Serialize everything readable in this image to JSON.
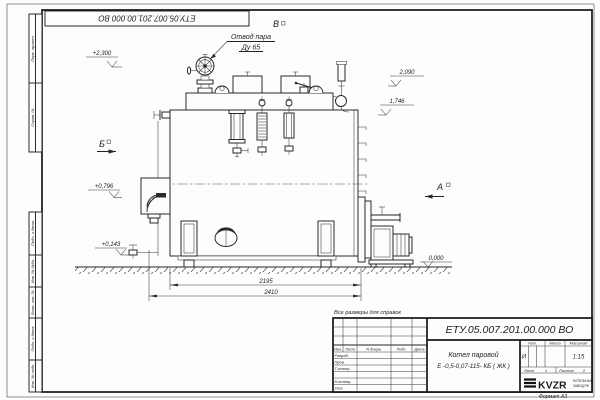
{
  "stamp": {
    "doc_number_rotated": "ЕТУ.05.007.201.00.000  ВО"
  },
  "margin_columns": {
    "top": [
      "Перв. примен.",
      "Справ. №"
    ],
    "bottom": [
      "Подп. и дата",
      "Инв. № дубл.",
      "Взам. инв. №",
      "Подп. и дата",
      "Инв. № подл."
    ]
  },
  "drawing": {
    "callout_steam_outlet": {
      "line1": "Отвод пара",
      "line2": "Ду 65"
    },
    "view_markers": {
      "b": "Б",
      "a": "А",
      "v": "В"
    },
    "elevation_marks": {
      "m2300": "+2,300",
      "m2090": "2,090",
      "m1746": "1,746",
      "m0796": "+0,796",
      "m0143": "+0,143",
      "m0000": "0,000"
    },
    "dimensions": {
      "d2195": "2195",
      "d2410": "2410"
    },
    "reference_note": "Все размеры для справок"
  },
  "title_block": {
    "doc_number": "ЕТУ.05.007.201.00.000  ВО",
    "product_line1": "Котел паровой",
    "product_line2": "Е -0,5-0,07-115- КБ ( ЖК )",
    "col_headers": {
      "izm": "Изм.",
      "list": "Лист",
      "ndoc": "N докум.",
      "podp": "Подп.",
      "date": "Дата"
    },
    "sig_rows": [
      "Разраб.",
      "Пров.",
      "Т.контр.",
      "Н.контр.",
      "Утв."
    ],
    "lit_header": "Лит.",
    "mass_header": "Масса",
    "scale_header": "Масштаб",
    "lit_value": "И",
    "scale_value": "1:15",
    "sheet": {
      "list_label": "Лист",
      "list_value": "1",
      "listov_label": "Листов",
      "listov_value": "2"
    },
    "logo": {
      "name": "KVZR",
      "sub_line1": "КОТЕЛЬНЫЙ",
      "sub_line2": "ЗАВОД РФ"
    },
    "format_label": "Формат  А3"
  }
}
